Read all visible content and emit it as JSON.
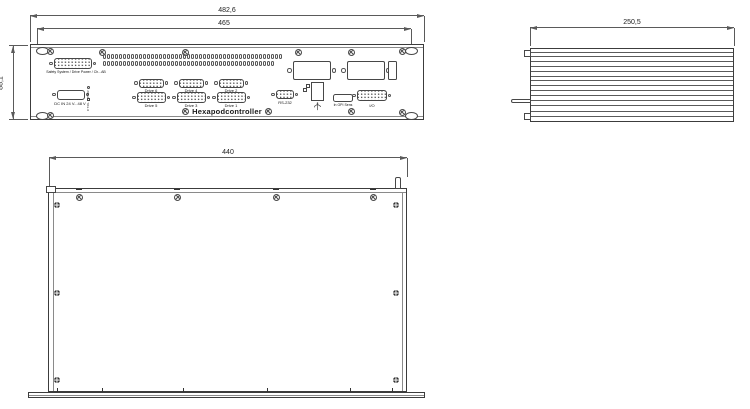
{
  "drawing": {
    "product_label": "Hexapodcontroller"
  },
  "dimensions": {
    "front_overall_width": "482,6",
    "front_mount_width": "465",
    "front_height": "88,1",
    "side_depth": "250,5",
    "bottom_width": "440"
  },
  "front_panel": {
    "safety_label": "Safety System / Drive Power / Ch...AB",
    "dc_in_label": "DC IN 24 V...48 V",
    "pwr_led_label": "PWR",
    "ctrl_led_label": "CTRL",
    "drive_labels_top": [
      "Drive 6",
      "Drive 4",
      "Drive 2"
    ],
    "drive_labels_bottom": [
      "Drive 5",
      "Drive 3",
      "Drive 1"
    ],
    "rs232_label": "RS-232",
    "gpi_label": "In GPI Sens",
    "io_label": "I/O"
  },
  "layout_counts": {
    "vent_slots": 88,
    "side_fins": 11
  }
}
